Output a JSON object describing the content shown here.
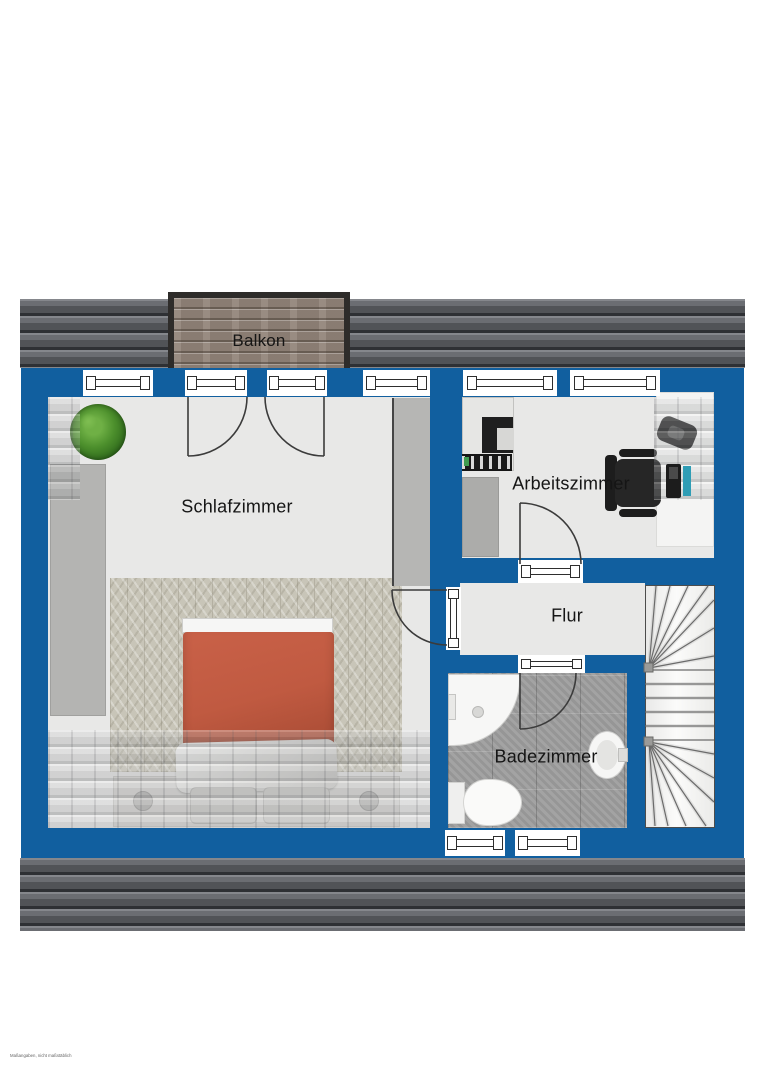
{
  "watermark": "Maßangaben, nicht maßstäblich",
  "rooms": {
    "balkon": {
      "label": "Balkon"
    },
    "schlafzimmer": {
      "label": "Schlafzimmer"
    },
    "arbeitszimmer": {
      "label": "Arbeitszimmer"
    },
    "flur": {
      "label": "Flur"
    },
    "badezimmer": {
      "label": "Badezimmer"
    }
  },
  "colors": {
    "wall_blue": "#115f9f",
    "roof_gray": "#55575b",
    "floor": "#e8e8e7",
    "bath_tile": "#9e9e9e",
    "carpet": "#c8c5b8",
    "duvet_orange": "#c05a41",
    "balcony_wood": "#93857a"
  }
}
